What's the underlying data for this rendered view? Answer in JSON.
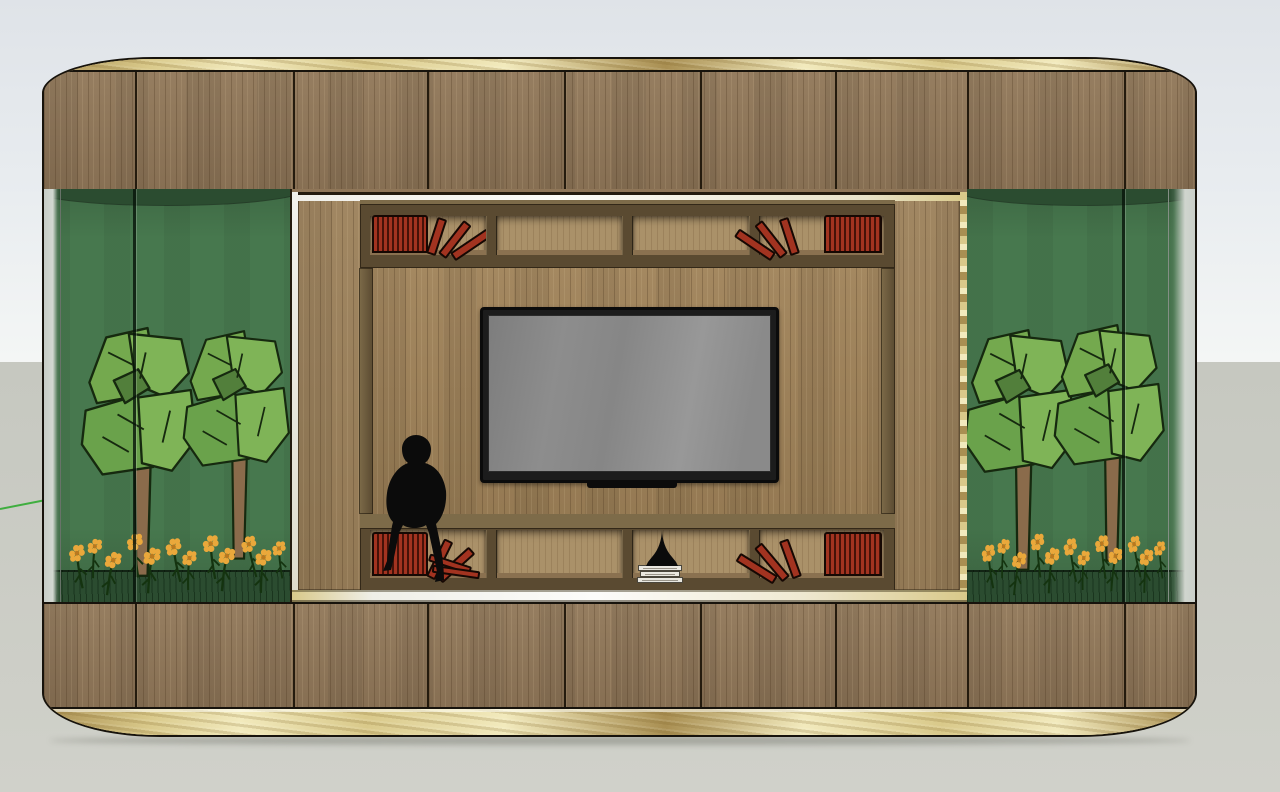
{
  "scene": {
    "title": "TV wall unit 3D render",
    "view": "front elevation in 3D viewport",
    "background": {
      "sky": "pale blue-gray gradient",
      "ground": "light warm gray",
      "horizon_y_px": 362
    },
    "helper": {
      "green_axis_line": "short green axis segment at left edge"
    }
  },
  "colors": {
    "sky-top": "#dfe3e8",
    "sky-mid": "#e9edf0",
    "sky-horizon": "#f4f6f5",
    "ground-top": "#c6c8c0",
    "ground-bottom": "#d0d1ca",
    "shadow": "rgba(95,98,88,0.38)",
    "outline": "#17130c",
    "seam": "#241b0e",
    "gold-light": "#f2eabd",
    "gold-mid": "#d9c98a",
    "gold-dark": "#a98f52",
    "wood-band": "#8f7658",
    "niche-wall": "#9b805a",
    "tv-panel": "#9e8158",
    "frame-face": "#5a4a31",
    "frame-lip": "#7d6b49",
    "cell-back": "#aa9169",
    "cell-floor": "#8a7150",
    "book-red": "#a23320",
    "book-dark": "#451208",
    "book-outline": "#160803",
    "terr-green": "#47784e",
    "terr-dark": "#2b4c30",
    "leaf-light": "#7fb457",
    "leaf-mid": "#74a94e",
    "leaf-mid2": "#6aa24b",
    "leaf-dark": "#527f3b",
    "leaf-outline": "#16290f",
    "trunk": "#8a6b4b",
    "flower-orange": "#eaa83b",
    "flower-center": "#b9791f",
    "stem-green": "#14330f",
    "glass-edge": "#c6ccc6",
    "axis-green": "#3fae3f",
    "tv-bezel": "#0b0b0b",
    "screen-mid": "#8d8d8d",
    "sill-white": "#fcfcfa",
    "stack-white": "#e9e7e0",
    "figure-black": "#0b0b0b"
  },
  "unit": {
    "trim_top": "gold band",
    "trim_bottom": "gold plinth band",
    "upper_panel_seams": 8,
    "lower_panel_seams": 8,
    "terrariums": [
      {
        "side": "left",
        "trees": 2,
        "flowers": 12,
        "mullions": 1
      },
      {
        "side": "right",
        "trees": 2,
        "flowers": 12,
        "mullions": 1
      }
    ],
    "niche": {
      "surround": "white-gold metal frame",
      "shelf_rows": 2,
      "compartments_per_row": 4,
      "book_groups": [
        {
          "row": "top",
          "compartment": 1,
          "style": "upright red block + 3 leaning"
        },
        {
          "row": "top",
          "compartment": 4,
          "style": "3 leaning + upright red block"
        },
        {
          "row": "bottom",
          "compartment": 1,
          "style": "upright red block + leaning + fallen"
        },
        {
          "row": "bottom",
          "compartment": 3,
          "style": "white book stack with black spire sculpture"
        },
        {
          "row": "bottom",
          "compartment": 4,
          "style": "leaning + upright red block"
        }
      ],
      "tv": {
        "state": "off",
        "screen": "blank gray"
      },
      "figure": "black seated ape sculpture on lower shelf edge"
    }
  }
}
